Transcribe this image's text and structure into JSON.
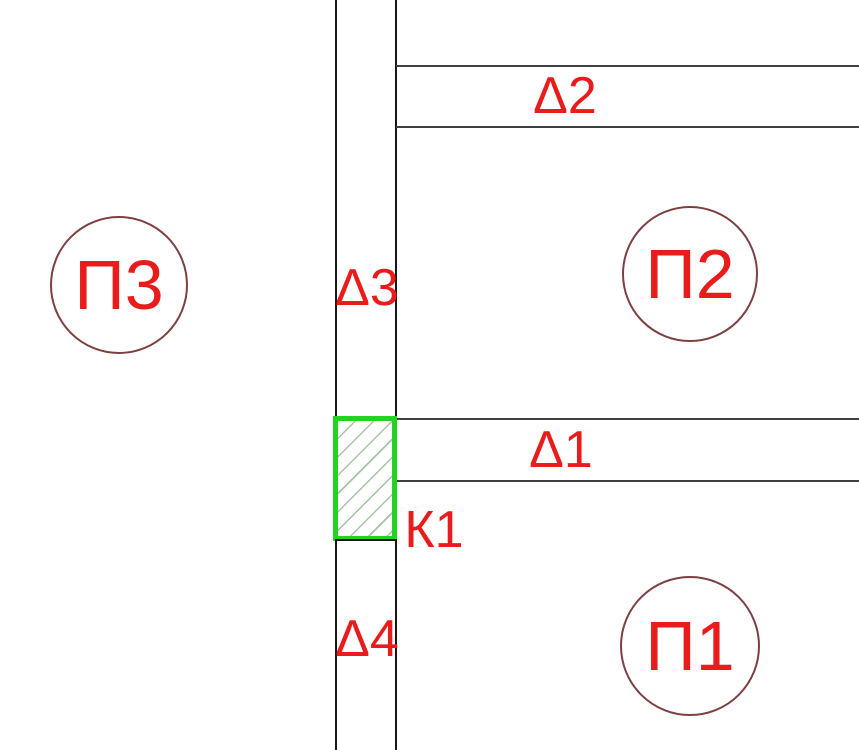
{
  "drawing": {
    "corridor_labels": {
      "d1": "Δ1",
      "d2": "Δ2",
      "d3": "Δ3",
      "d4": "Δ4"
    },
    "element_label": {
      "k1": "К1"
    },
    "circles": [
      {
        "label": "П3"
      },
      {
        "label": "П2"
      },
      {
        "label": "П1"
      }
    ],
    "colors": {
      "label_red": "#e91b1b",
      "circle_stroke": "#7e4040",
      "highlight_green": "#22d322",
      "hatch_line": "#a6c3a6",
      "wall_line": "#161616"
    }
  }
}
